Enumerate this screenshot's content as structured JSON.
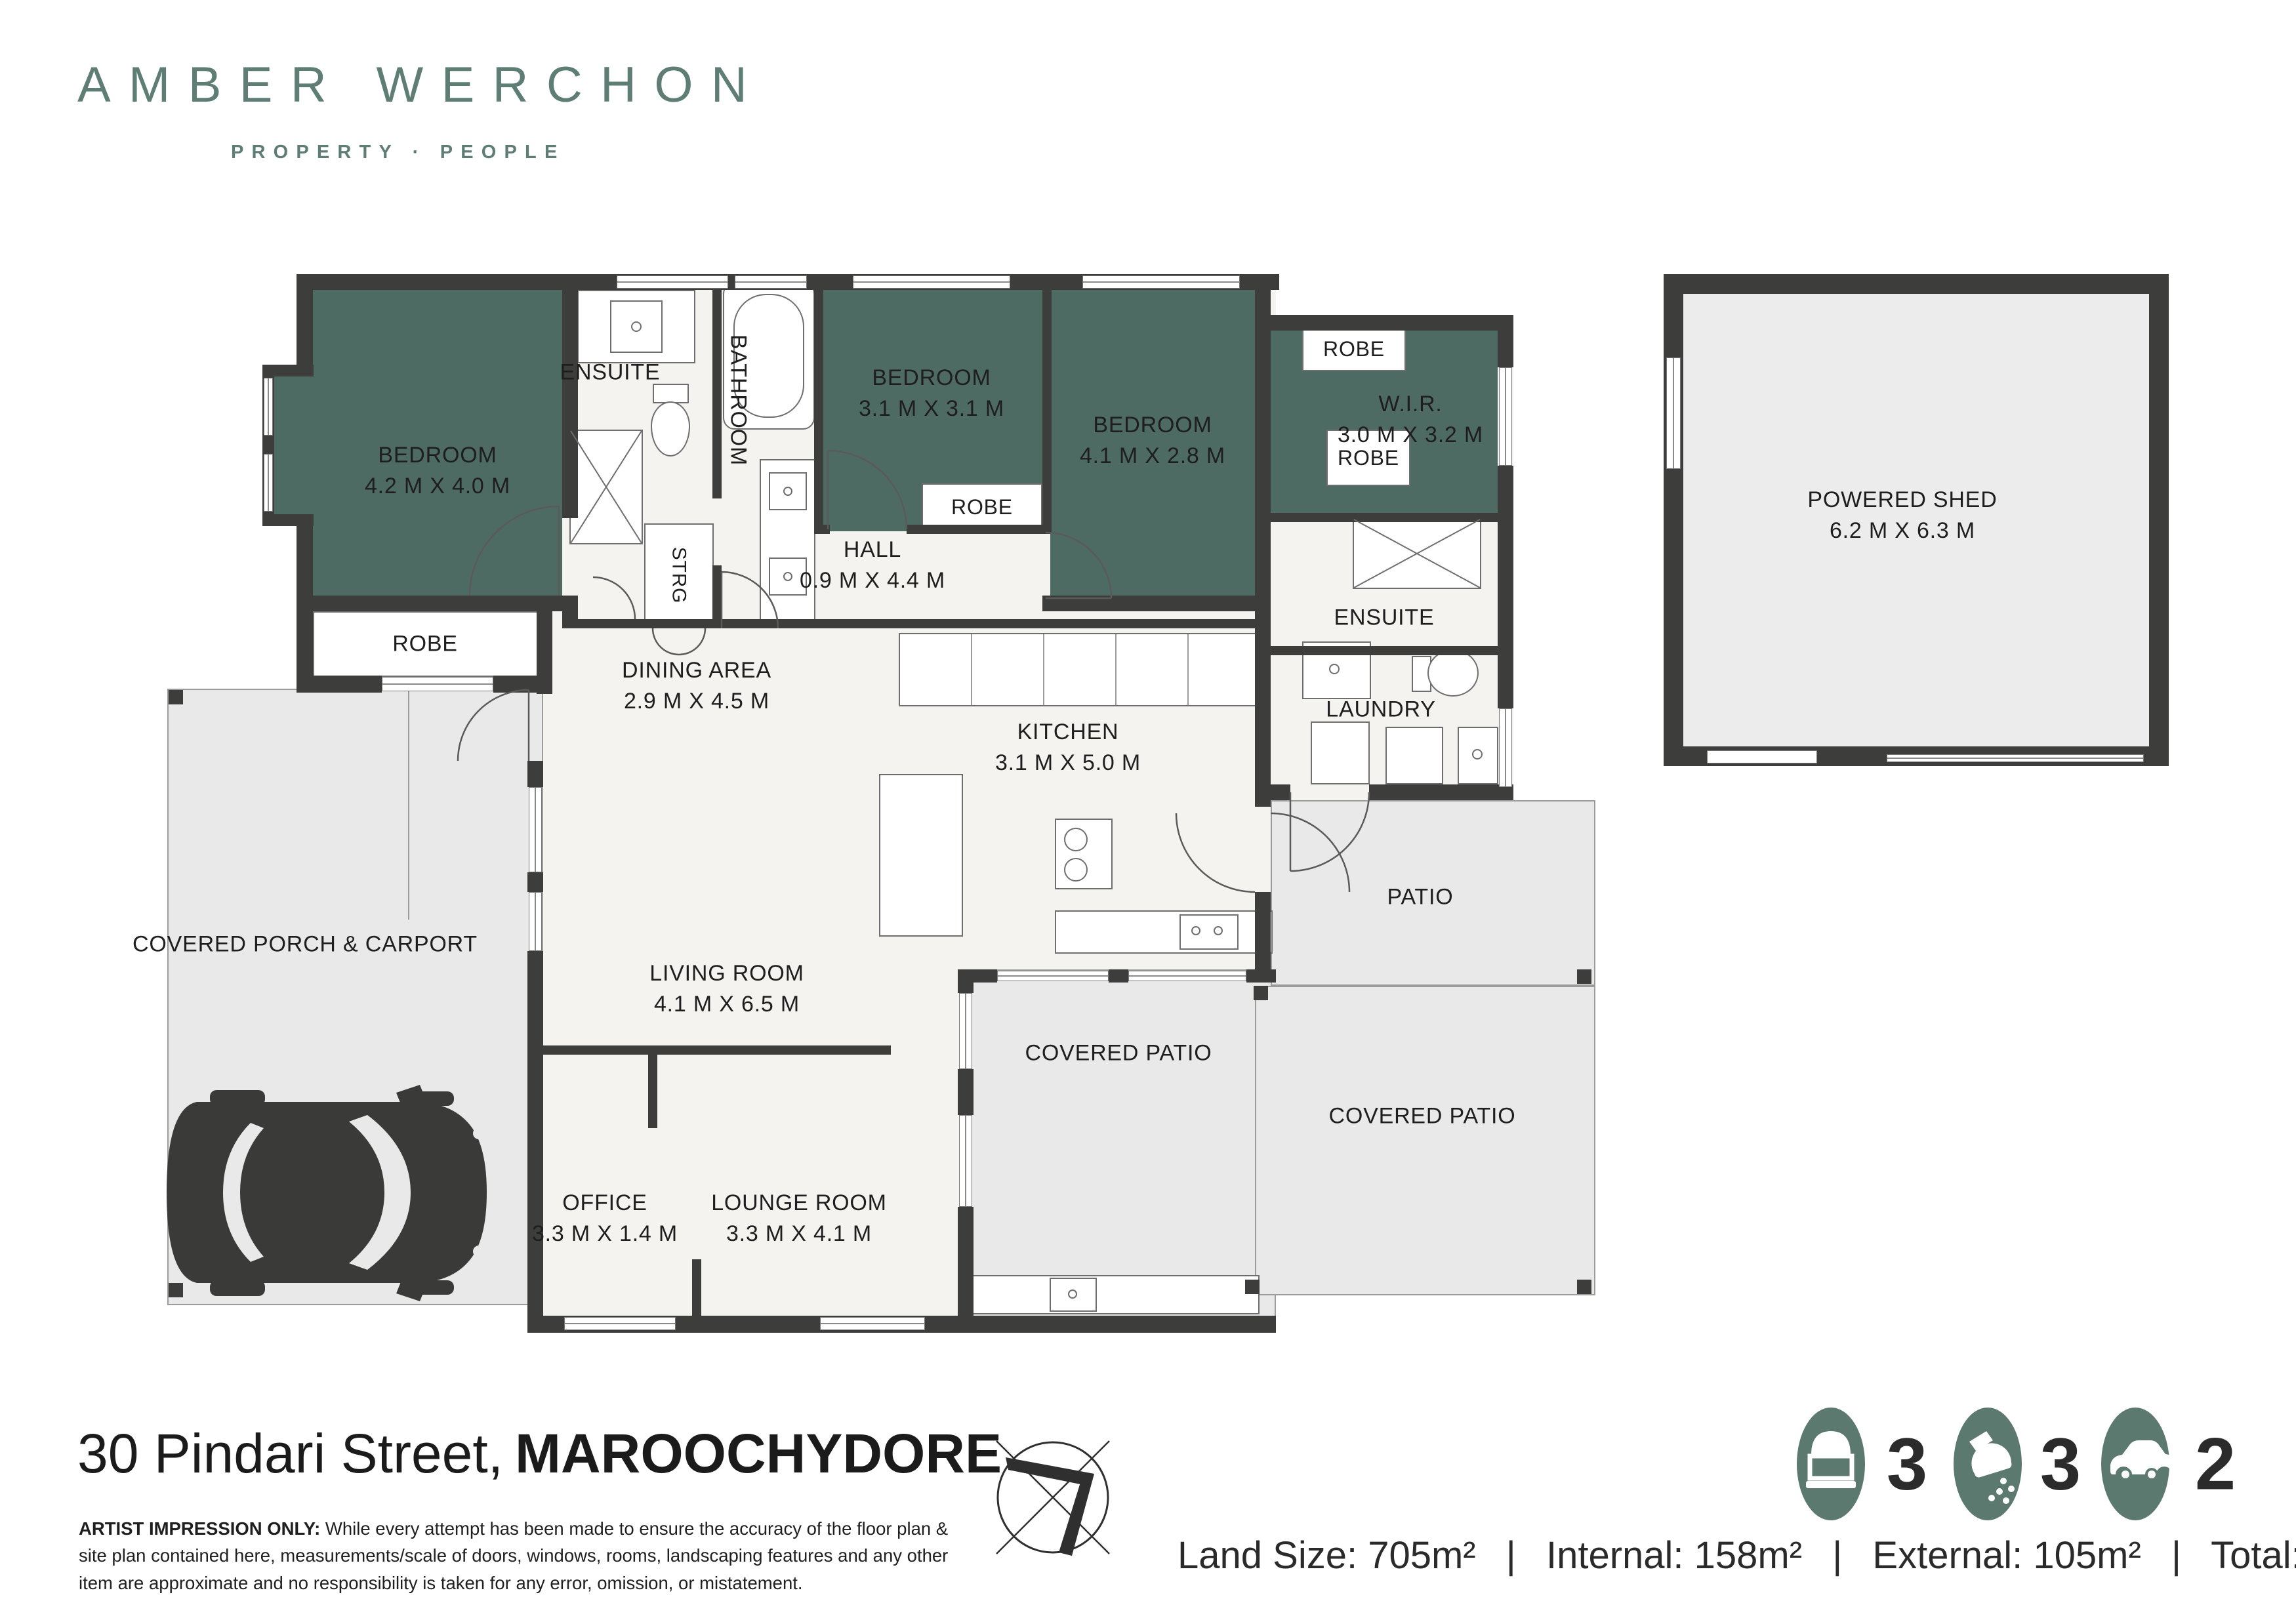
{
  "brand": {
    "name": "AMBER WERCHON",
    "tagline": "PROPERTY · PEOPLE"
  },
  "rooms": {
    "bedroom1": {
      "name": "BEDROOM",
      "dims": "4.2 M X 4.0 M"
    },
    "bedroom2": {
      "name": "BEDROOM",
      "dims": "3.1 M X 3.1 M"
    },
    "bedroom3": {
      "name": "BEDROOM",
      "dims": "4.1 M X 2.8 M"
    },
    "ensuite1": {
      "name": "ENSUITE"
    },
    "ensuite2": {
      "name": "ENSUITE"
    },
    "bathroom": {
      "name": "BATHROOM"
    },
    "strg": {
      "name": "STRG"
    },
    "robe1": {
      "name": "ROBE"
    },
    "robe2": {
      "name": "ROBE"
    },
    "robe3": {
      "name": "ROBE"
    },
    "robe4": {
      "name": "ROBE"
    },
    "wir": {
      "name": "W.I.R.",
      "dims": "3.0 M X 3.2 M"
    },
    "hall": {
      "name": "HALL",
      "dims": "0.9 M X 4.4 M"
    },
    "dining": {
      "name": "DINING AREA",
      "dims": "2.9 M X 4.5 M"
    },
    "kitchen": {
      "name": "KITCHEN",
      "dims": "3.1 M X 5.0 M"
    },
    "living": {
      "name": "LIVING ROOM",
      "dims": "4.1 M X 6.5 M"
    },
    "laundry": {
      "name": "LAUNDRY"
    },
    "office": {
      "name": "OFFICE",
      "dims": "3.3 M X 1.4 M"
    },
    "lounge": {
      "name": "LOUNGE ROOM",
      "dims": "3.3 M X 4.1 M"
    },
    "porch": {
      "name": "COVERED PORCH & CARPORT"
    },
    "patio": {
      "name": "PATIO"
    },
    "covered_patio_mid": {
      "name": "COVERED PATIO"
    },
    "covered_patio_right": {
      "name": "COVERED PATIO"
    },
    "shed": {
      "name": "POWERED SHED",
      "dims": "6.2 M X 6.3 M"
    }
  },
  "footer": {
    "address_street": "30 Pindari Street,",
    "address_suburb": "MAROOCHYDORE",
    "disclaimer_label": "ARTIST IMPRESSION ONLY:",
    "disclaimer_text": " While every attempt has been made to ensure the accuracy of the floor plan & site plan contained here, measurements/scale of doors, windows, rooms, landscaping features and any other item are approximate and no responsibility is taken for any error, omission, or mistatement.",
    "stats_separator": "|",
    "stats": [
      {
        "label": "Land Size:",
        "value": "705m²"
      },
      {
        "label": "Internal:",
        "value": "158m²"
      },
      {
        "label": "External:",
        "value": "105m²"
      },
      {
        "label": "Total:",
        "value": "263m²"
      }
    ],
    "features": [
      {
        "icon": "bed-icon",
        "count": "3"
      },
      {
        "icon": "shower-icon",
        "count": "3"
      },
      {
        "icon": "car-icon",
        "count": "2"
      }
    ]
  },
  "colors": {
    "brand_green": "#5e7d74",
    "room_green": "#4e6b63",
    "wall": "#3d3d3c",
    "icon_green": "#5c7970",
    "exterior_gray": "#e9e9e9",
    "interior_cream": "#f5f3ef"
  }
}
